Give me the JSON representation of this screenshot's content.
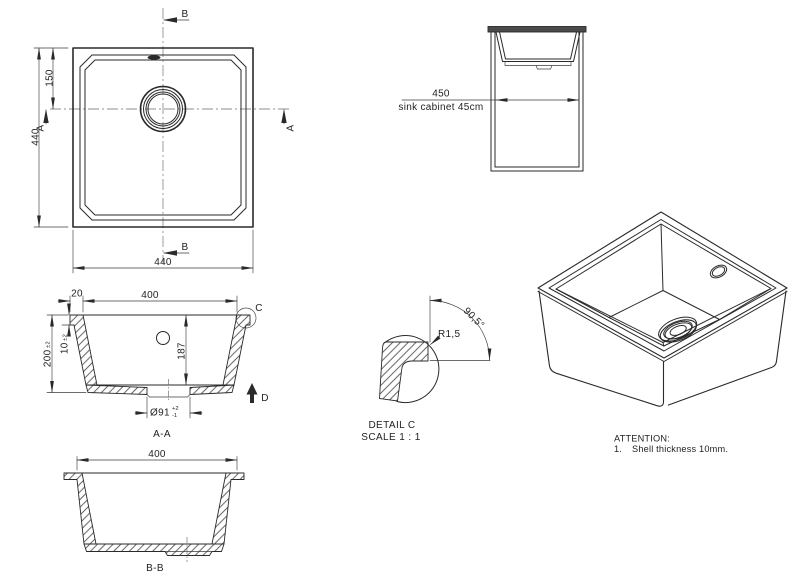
{
  "colors": {
    "line": "#2a2a2a",
    "countertop_fill": "#4a4a4a",
    "paper": "#ffffff"
  },
  "plan_view": {
    "dim_width_bottom": "440",
    "dim_height_left": "440",
    "dim_drain_offset": "150",
    "section_b_top": "B",
    "section_b_bottom": "B",
    "section_a_left": "A",
    "section_a_right": "A"
  },
  "cabinet_view": {
    "dim_width": "450",
    "caption": "sink cabinet 45cm"
  },
  "section_aa": {
    "title": "A-A",
    "dim_opening": "400",
    "dim_rim": "20",
    "dim_height": "200",
    "dim_height_tol": "±2",
    "dim_lip": "10",
    "dim_lip_tol": "±2",
    "dim_depth": "187",
    "dim_drain": "Ø91",
    "dim_drain_tol_plus": "+2",
    "dim_drain_tol_minus": "-1",
    "detail_label": "C",
    "view_label": "D"
  },
  "section_bb": {
    "title": "B-B",
    "dim_opening": "400"
  },
  "detail_c": {
    "title": "DETAIL C",
    "scale": "SCALE 1 : 1",
    "radius": "R1,5",
    "angle": "90,5°"
  },
  "notes": {
    "heading": "ATTENTION:",
    "item_number": "1.",
    "item_text": "Shell thickness 10mm."
  }
}
